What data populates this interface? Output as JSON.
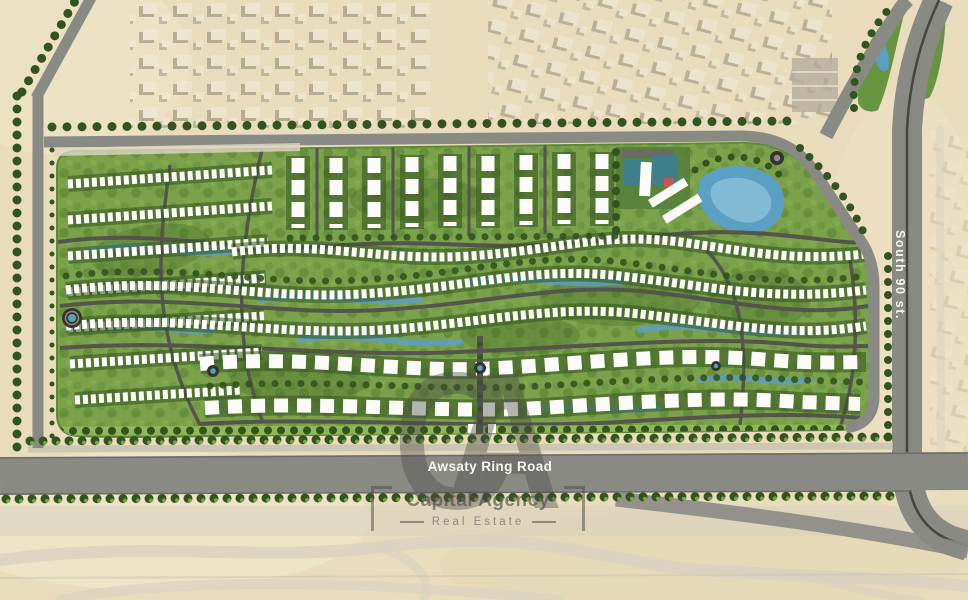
{
  "map": {
    "title": "Residential compound master plan aerial view",
    "roads": {
      "ring_road_label": "Awsaty Ring Road",
      "south_street_label": "South 90 st."
    },
    "watermark": {
      "initials": "CA",
      "name": "Capital Agency",
      "tagline": "Real Estate"
    },
    "colors": {
      "sand": "#e9dcbd",
      "site_green": "#7ba14b",
      "light_green": "#9cc25e",
      "dark_green": "#33541f",
      "road_gray": "#8a8a85",
      "street_dark": "#54554c",
      "water_blue": "#5b9fc2",
      "building_white": "#fbfbf7",
      "watermark_gray": "#4a4a47",
      "label_white": "#f6f6f3"
    }
  }
}
